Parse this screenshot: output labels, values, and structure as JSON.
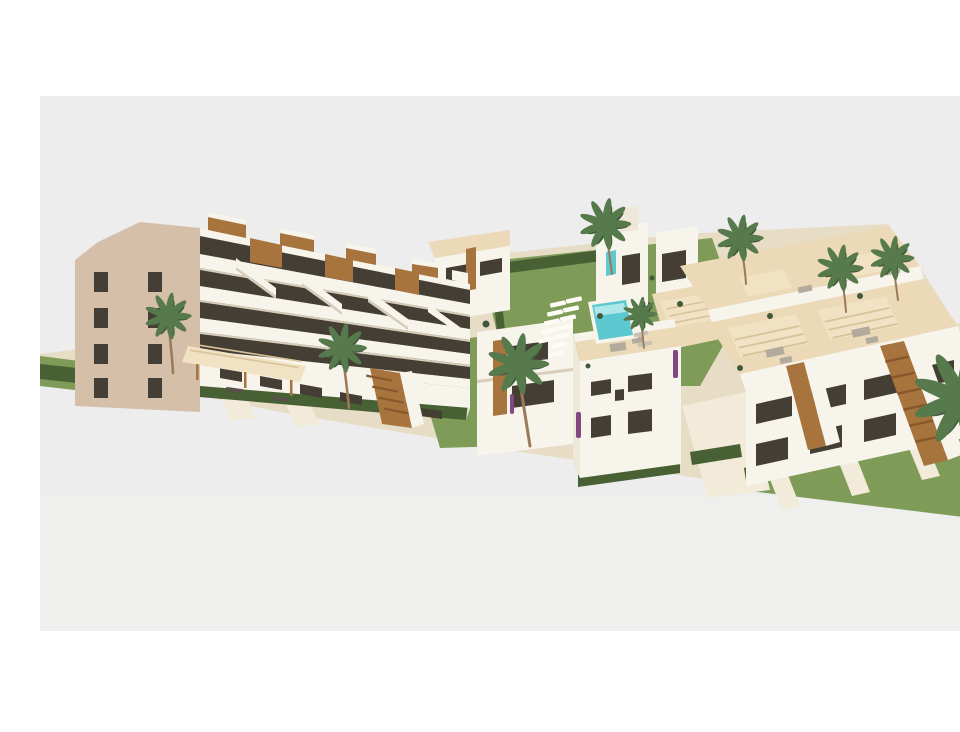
{
  "meta": {
    "type": "architectural-3d-render",
    "description": "Aerial 3D architectural rendering of a new-build Mediterranean residential complex: a large four-storey apartment building with stepped white balconies and wood accents on the left, rows of two-storey townhouses with sand-coloured rooftop terraces, pergolas and external wooden staircases in the centre and right, a turquoise swimming pool with white sun loungers on a green lawn, trimmed hedges, pale footpaths and tall palm trees, all on a light grey studio background with white bands above and below."
  },
  "scene": {
    "elements": [
      "apartment-building-left",
      "gable-wall",
      "stepped-balconies",
      "rooftop-pergolas",
      "townhouse-row-back",
      "villa-center",
      "roof-terrace-pergolas",
      "white-townhouse-front",
      "townhouse-block-right",
      "wooden-staircases",
      "swimming-pool",
      "sun-loungers",
      "lawns",
      "hedges",
      "footpaths",
      "palm-trees",
      "bougainvillea-accents",
      "benches"
    ]
  },
  "palette": {
    "page_bg": "#FFFFFF",
    "sky": "#ECEDEC",
    "sky_low": "#F1F1EF",
    "ground_sand": "#E7DDC6",
    "path_light": "#F2EBD9",
    "lawn": "#7E9C57",
    "hedge": "#476034",
    "wall_white": "#F7F4EC",
    "wall_cream": "#EFE8D8",
    "wall_shadow": "#D7CDBA",
    "gable_tan": "#D5BFA9",
    "glass": "#453E34",
    "roof_sand": "#EBD9B7",
    "pergola": "#F0E2C2",
    "pergola_line": "#D8C299",
    "wood": "#A8743E",
    "wood_dark": "#86582B",
    "pool": "#5CC8D0",
    "pool_light": "#AEE7E8",
    "lounger_white": "#FCFBF6",
    "lounger_gray": "#C7C1B2",
    "furniture_gray": "#B2AB9D",
    "trunk": "#9A7A57",
    "palm": "#567A4B",
    "palm_dark": "#40593A",
    "purple": "#81497F",
    "bench": "#58524A"
  }
}
